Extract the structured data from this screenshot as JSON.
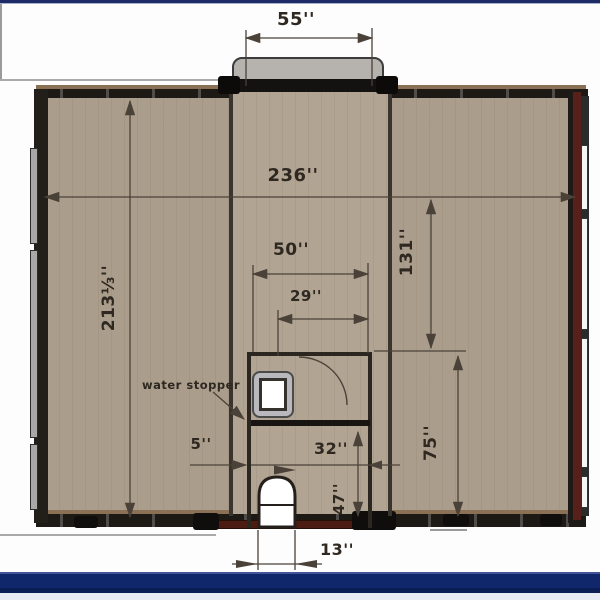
{
  "plan": {
    "labels": {
      "porch_width": "55''",
      "overall_width": "236''",
      "overall_depth": "213⅓''",
      "right_room_depth": "131''",
      "bath_outer_width": "50''",
      "bath_door_span": "29''",
      "left_gap": "5''",
      "bath_inner_width": "32''",
      "wc_depth": "47''",
      "right_lower_depth": "75''",
      "door_width": "13''",
      "water_stopper": "water stopper"
    },
    "colors": {
      "floor": "#ab9d8b",
      "floor_center": "#b2a492",
      "wall": "#1d1a16",
      "wall_top_accent": "#8a7155",
      "maroon_wall": "#57201a",
      "porch": "#b6b3ae",
      "top_bar": "#1d2b66",
      "bottom_band": "#10276b",
      "dimension_ink": "#4a4238"
    }
  }
}
